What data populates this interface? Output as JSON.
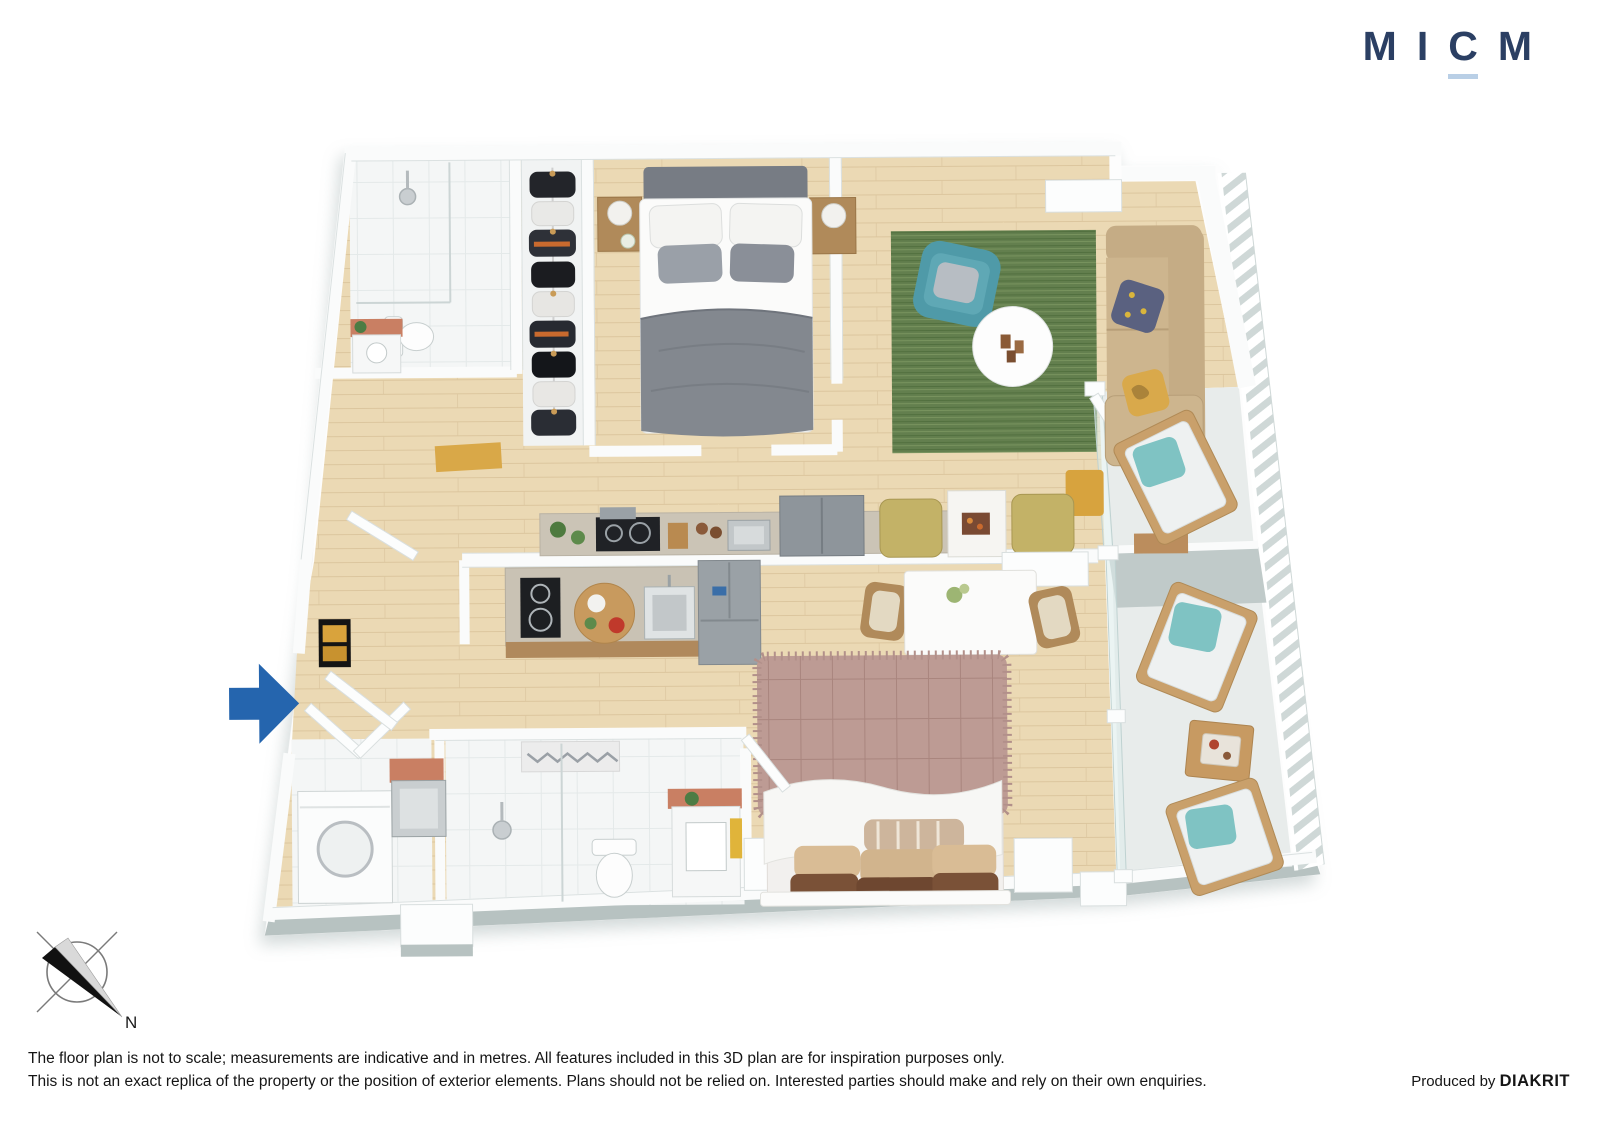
{
  "logo": {
    "letters": [
      "M",
      "I",
      "C",
      "M"
    ],
    "color": "#2b3f63",
    "underline_color": "#b9cfe6"
  },
  "compass": {
    "label": "N"
  },
  "entry_arrow": {
    "direction": "right",
    "color": "#2565ae"
  },
  "footer": {
    "line1": "The floor plan is not to scale; measurements are indicative and in metres. All features included in this 3D plan are for inspiration purposes only.",
    "line2": "This is not an exact replica of the property or the position of exterior elements. Plans should not be relied on. Interested parties should make and rely on their own enquiries.",
    "produced_by_prefix": "Produced by ",
    "producer": "DIAKRIT"
  },
  "floorplan": {
    "type": "3d-floor-plan",
    "rooms": [
      "ensuite-bathroom",
      "walk-in-wardrobe",
      "bedroom-1",
      "living-room",
      "kitchen-upper",
      "kitchen-lower",
      "dining-area",
      "dining-nook",
      "bedroom-2",
      "bathroom-2",
      "laundry",
      "entry-hall",
      "balcony-upper",
      "balcony-lower"
    ],
    "furniture": [
      "double-bed-grey",
      "bedside-tables",
      "hanging-clothes-rail",
      "shower",
      "toilet",
      "vanity",
      "teal-armchair",
      "green-rug",
      "round-coffee-table",
      "tan-sofa",
      "tv-sideboard",
      "cooktop",
      "kitchen-sink",
      "fridge",
      "dining-table-chairs",
      "yellow-bench-nook",
      "double-bed-pink",
      "washing-machine",
      "laundry-trough",
      "balcony-lounge-chairs",
      "balcony-coffee-table",
      "balustrade"
    ],
    "palette": {
      "timber_floor": "#ebd9b4",
      "tile_floor": "#f4f6f6",
      "wall_white": "#fafbfb",
      "wall_edge": "#dbe1e1",
      "slab_grey": "#b7c2c1",
      "rug_green": "#637f4e",
      "armchair_teal": "#4f9aa8",
      "sofa_tan": "#c9b089",
      "pillow_navy": "#5a6180",
      "pillow_yellow": "#d9a94b",
      "bed1_grey": "#83888f",
      "bed2_mauve": "#bd9b94",
      "splashback_terracotta": "#c97f63",
      "appliance_steel": "#9aa1a6",
      "cooktop_black": "#1d1f22",
      "balcony_stone": "#e8eceb",
      "balcony_teal_pillow": "#7fc3c3",
      "lounge_frame": "#c9a06b"
    }
  }
}
